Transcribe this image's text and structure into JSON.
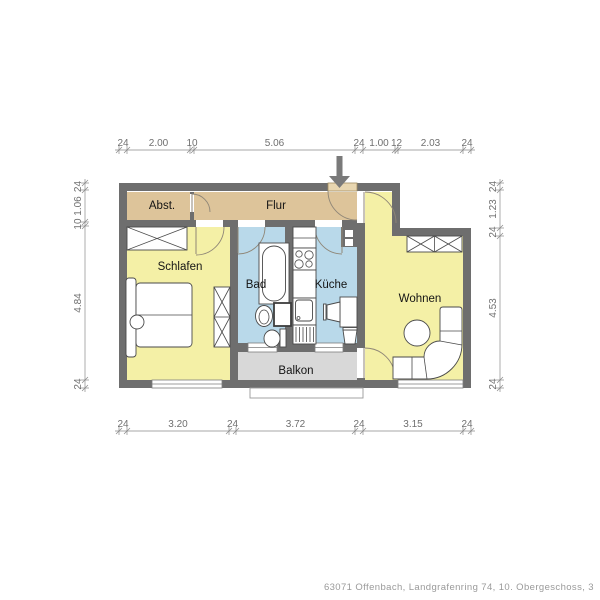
{
  "palette": {
    "wall": "#6e6e6e",
    "corridor": "#ddc49a",
    "room": "#f4f0a6",
    "wet": "#b9d9ea",
    "balcony": "#d8d8d8",
    "caption": "#9a9a9a"
  },
  "rooms": {
    "abst": {
      "label": "Abst.",
      "x": 162,
      "y": 209
    },
    "flur": {
      "label": "Flur",
      "x": 276,
      "y": 209
    },
    "schlafen": {
      "label": "Schlafen",
      "x": 180,
      "y": 270
    },
    "bad": {
      "label": "Bad",
      "x": 256,
      "y": 288
    },
    "kueche": {
      "label": "Küche",
      "x": 331,
      "y": 288
    },
    "wohnen": {
      "label": "Wohnen",
      "x": 420,
      "y": 302
    },
    "balkon": {
      "label": "Balkon",
      "x": 296,
      "y": 374
    }
  },
  "dims": {
    "top": {
      "y": 150,
      "bounds": [
        119,
        127,
        190,
        194,
        355,
        363,
        395,
        398,
        463,
        471
      ],
      "labels": [
        "24",
        "2.00",
        "10",
        "5.06",
        "24",
        "1.00",
        "12",
        "2.03",
        "24"
      ]
    },
    "bottom": {
      "y": 431,
      "bounds": [
        119,
        127,
        229,
        236,
        355,
        363,
        463,
        471
      ],
      "labels": [
        "24",
        "3.20",
        "24",
        "3.72",
        "24",
        "3.15",
        "24"
      ]
    },
    "left": {
      "x": 85,
      "bounds": [
        183,
        190,
        222,
        226,
        380,
        388
      ],
      "labels": [
        "24",
        "1.06",
        "10",
        "4.84",
        "24"
      ]
    },
    "right": {
      "x": 500,
      "bounds": [
        183,
        190,
        228,
        236,
        380,
        388
      ],
      "labels": [
        "24",
        "1.23",
        "24",
        "4.53",
        "24"
      ]
    }
  },
  "icons": {
    "entrance_arrow": "entrance-down-arrow"
  },
  "caption": "63071 Offenbach, Landgrafenring 74, 10. Obergeschoss, 3"
}
